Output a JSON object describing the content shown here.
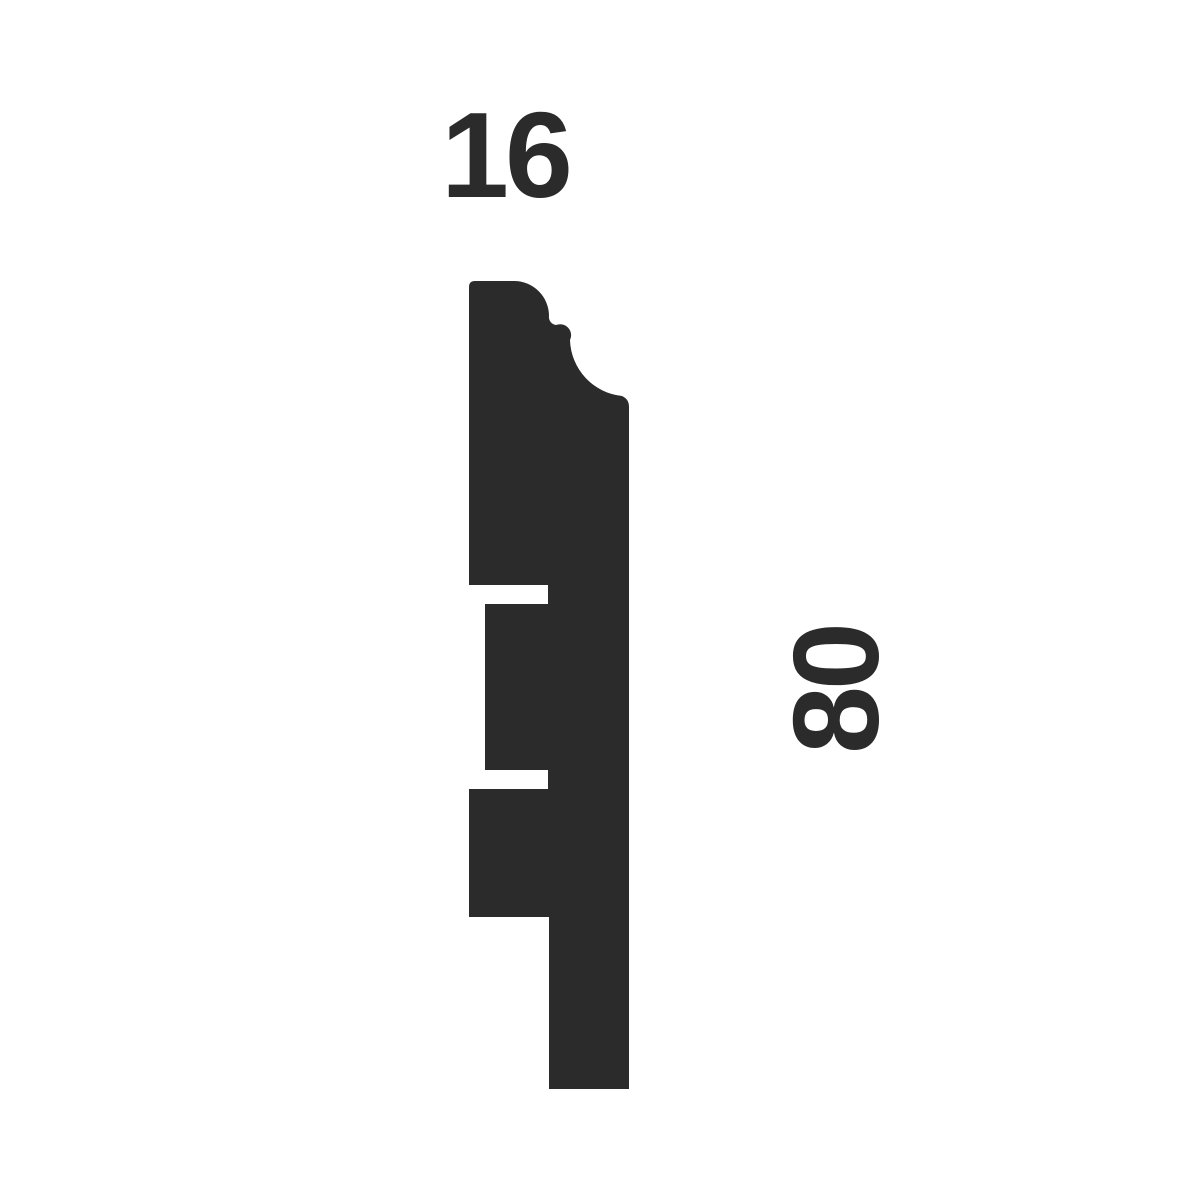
{
  "page": {
    "background_color": "#ffffff"
  },
  "diagram": {
    "type": "technical-profile-cross-section",
    "subject": "moulding-skirting-board-profile",
    "shape_color": "#2b2b2b",
    "label_color": "#2b2b2b",
    "width_dimension": "16",
    "height_dimension": "80"
  }
}
